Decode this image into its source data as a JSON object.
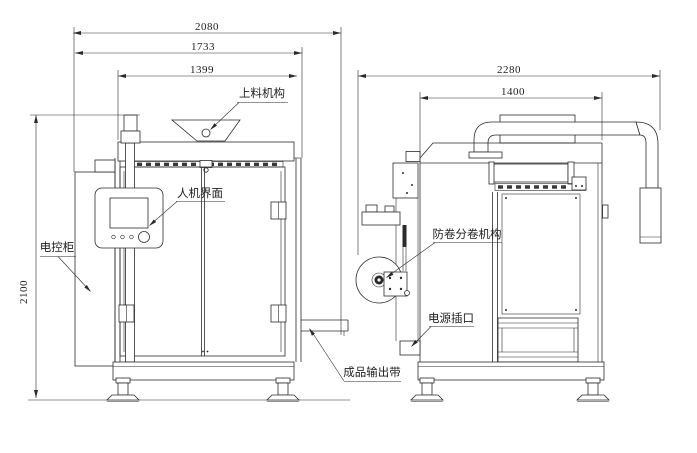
{
  "front_view": {
    "dimensions": {
      "overall_width": "2080",
      "frame_width": "1733",
      "body_width": "1399",
      "height": "2100"
    },
    "labels": {
      "feeder": "上料机构",
      "hmi": "人机界面",
      "cabinet": "电控柜",
      "output_belt": "成品输出带"
    }
  },
  "side_view": {
    "dimensions": {
      "overall_depth": "2280",
      "body_depth": "1400"
    },
    "labels": {
      "anti_roll": "防卷分卷机构",
      "power_socket": "电源插口"
    }
  },
  "colors": {
    "line": "#2b2b2b",
    "background": "#ffffff"
  }
}
